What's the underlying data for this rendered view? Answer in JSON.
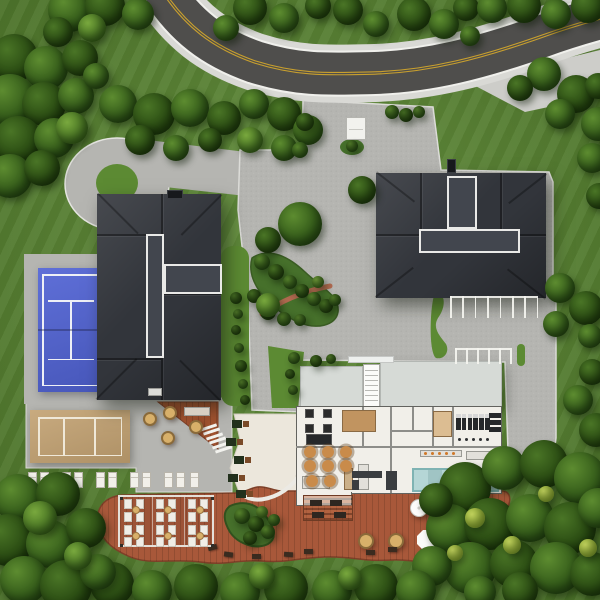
{
  "scene": {
    "description": "aerial-3d-site-plan-render-resort-clubhouse",
    "canvas": {
      "width": 600,
      "height": 600
    }
  },
  "palette": {
    "grass": "#5c8a33",
    "paving": "#b5b5b1",
    "pavingLight": "#cdcdc9",
    "curb": "#e6e6e2",
    "road": "#4f4e4c",
    "shoulder": "#d9d9d5",
    "roadEdge": "#f0f0ec",
    "roadYellow": "#c9a02e",
    "roof": "#32353b",
    "roofPanel": "#42464e",
    "roofTrim": "#e9e9e7",
    "tennis": "#5163d4",
    "tennisLine": "#eef0f6",
    "sand": "#c2a171",
    "sandLine": "#efe8d8",
    "deck": "#a8583a",
    "cream": "#ece7dc",
    "floor": "#f1efe9",
    "flatRoof": "#d6dad6",
    "pool": "#a9cfcf",
    "wood": "#c19460",
    "tableTan": "#c98b4a",
    "planter": "#46702b"
  },
  "trees": [
    [
      70,
      10,
      22,
      1
    ],
    [
      105,
      6,
      20,
      0
    ],
    [
      138,
      14,
      16,
      1
    ],
    [
      58,
      32,
      15,
      0
    ],
    [
      92,
      28,
      14,
      2
    ],
    [
      14,
      58,
      24,
      0
    ],
    [
      46,
      68,
      22,
      1
    ],
    [
      80,
      58,
      18,
      0
    ],
    [
      10,
      100,
      26,
      1
    ],
    [
      44,
      104,
      22,
      0
    ],
    [
      76,
      96,
      18,
      1
    ],
    [
      18,
      140,
      24,
      0
    ],
    [
      54,
      138,
      20,
      1
    ],
    [
      10,
      176,
      22,
      1
    ],
    [
      42,
      168,
      18,
      0
    ],
    [
      72,
      128,
      16,
      2
    ],
    [
      96,
      76,
      13,
      1
    ],
    [
      118,
      104,
      19,
      1
    ],
    [
      154,
      114,
      21,
      0
    ],
    [
      190,
      108,
      19,
      1
    ],
    [
      224,
      118,
      17,
      0
    ],
    [
      254,
      104,
      15,
      1
    ],
    [
      284,
      114,
      17,
      0
    ],
    [
      308,
      130,
      15,
      1
    ],
    [
      250,
      140,
      13,
      2
    ],
    [
      284,
      148,
      13,
      1
    ],
    [
      140,
      140,
      15,
      0
    ],
    [
      176,
      148,
      13,
      1
    ],
    [
      210,
      140,
      12,
      0
    ],
    [
      250,
      8,
      17,
      0
    ],
    [
      284,
      18,
      15,
      1
    ],
    [
      318,
      6,
      13,
      0
    ],
    [
      226,
      28,
      13,
      1
    ],
    [
      348,
      10,
      15,
      0
    ],
    [
      376,
      24,
      13,
      1
    ],
    [
      414,
      14,
      17,
      0
    ],
    [
      444,
      24,
      15,
      1
    ],
    [
      466,
      8,
      13,
      0
    ],
    [
      492,
      8,
      15,
      1
    ],
    [
      524,
      6,
      17,
      0
    ],
    [
      556,
      14,
      15,
      1
    ],
    [
      588,
      6,
      17,
      0
    ],
    [
      470,
      36,
      10,
      1
    ],
    [
      544,
      74,
      17,
      1
    ],
    [
      576,
      94,
      19,
      0
    ],
    [
      598,
      124,
      17,
      1
    ],
    [
      520,
      88,
      13,
      0
    ],
    [
      560,
      114,
      15,
      1
    ],
    [
      598,
      86,
      13,
      0
    ],
    [
      592,
      158,
      15,
      1
    ],
    [
      599,
      196,
      13,
      0
    ],
    [
      560,
      288,
      15,
      1
    ],
    [
      586,
      308,
      17,
      0
    ],
    [
      556,
      324,
      13,
      1
    ],
    [
      590,
      336,
      12,
      1
    ],
    [
      592,
      372,
      13,
      0
    ],
    [
      578,
      400,
      15,
      1
    ],
    [
      596,
      430,
      17,
      0
    ],
    [
      465,
      488,
      26,
      0
    ],
    [
      504,
      468,
      22,
      1
    ],
    [
      544,
      464,
      24,
      0
    ],
    [
      580,
      478,
      26,
      1
    ],
    [
      450,
      528,
      24,
      1
    ],
    [
      490,
      524,
      26,
      0
    ],
    [
      530,
      518,
      24,
      1
    ],
    [
      570,
      528,
      26,
      0
    ],
    [
      598,
      508,
      20,
      1
    ],
    [
      470,
      568,
      26,
      1
    ],
    [
      514,
      564,
      24,
      0
    ],
    [
      556,
      568,
      26,
      1
    ],
    [
      592,
      574,
      22,
      0
    ],
    [
      432,
      566,
      20,
      1
    ],
    [
      436,
      500,
      17,
      0
    ],
    [
      475,
      518,
      10,
      3
    ],
    [
      512,
      545,
      9,
      3
    ],
    [
      455,
      553,
      8,
      3
    ],
    [
      546,
      494,
      8,
      3
    ],
    [
      588,
      548,
      9,
      3
    ],
    [
      520,
      590,
      18,
      0
    ],
    [
      480,
      592,
      16,
      1
    ],
    [
      112,
      584,
      22,
      0
    ],
    [
      152,
      590,
      20,
      1
    ],
    [
      196,
      586,
      22,
      0
    ],
    [
      240,
      592,
      20,
      1
    ],
    [
      286,
      588,
      22,
      0
    ],
    [
      332,
      590,
      20,
      1
    ],
    [
      376,
      586,
      22,
      0
    ],
    [
      416,
      590,
      20,
      1
    ],
    [
      262,
      576,
      13,
      2
    ],
    [
      350,
      578,
      12,
      2
    ],
    [
      18,
      498,
      24,
      1
    ],
    [
      58,
      494,
      22,
      0
    ],
    [
      8,
      540,
      26,
      0
    ],
    [
      50,
      544,
      24,
      1
    ],
    [
      86,
      528,
      20,
      0
    ],
    [
      24,
      580,
      24,
      1
    ],
    [
      66,
      586,
      26,
      0
    ],
    [
      98,
      572,
      18,
      1
    ],
    [
      40,
      518,
      17,
      2
    ],
    [
      78,
      556,
      14,
      2
    ],
    [
      300,
      224,
      22,
      1
    ],
    [
      268,
      240,
      13,
      0
    ],
    [
      362,
      190,
      14,
      0
    ],
    [
      392,
      112,
      7,
      1
    ],
    [
      406,
      115,
      7,
      0
    ],
    [
      419,
      112,
      6,
      1
    ],
    [
      305,
      122,
      9,
      0
    ],
    [
      300,
      150,
      8,
      1
    ],
    [
      262,
      262,
      8,
      1
    ],
    [
      276,
      272,
      8,
      0
    ],
    [
      290,
      282,
      7,
      1
    ],
    [
      302,
      291,
      7,
      0
    ],
    [
      314,
      299,
      7,
      1
    ],
    [
      326,
      306,
      7,
      0
    ],
    [
      268,
      312,
      8,
      0
    ],
    [
      284,
      319,
      7,
      1
    ],
    [
      254,
      296,
      7,
      0
    ],
    [
      300,
      320,
      6,
      1
    ],
    [
      318,
      282,
      6,
      2
    ],
    [
      335,
      300,
      6,
      1
    ],
    [
      268,
      305,
      12,
      2
    ],
    [
      352,
      146,
      6,
      1
    ],
    [
      236,
      298,
      6,
      0
    ],
    [
      238,
      314,
      5,
      1
    ],
    [
      236,
      330,
      5,
      0
    ],
    [
      239,
      348,
      5,
      1
    ],
    [
      241,
      366,
      6,
      0
    ],
    [
      243,
      384,
      5,
      1
    ],
    [
      245,
      400,
      5,
      0
    ],
    [
      294,
      358,
      6,
      1
    ],
    [
      290,
      374,
      5,
      0
    ],
    [
      293,
      390,
      5,
      1
    ],
    [
      316,
      361,
      6,
      0
    ],
    [
      331,
      359,
      5,
      1
    ],
    [
      242,
      516,
      8,
      1
    ],
    [
      256,
      524,
      8,
      0
    ],
    [
      268,
      532,
      7,
      1
    ],
    [
      250,
      538,
      7,
      0
    ],
    [
      262,
      512,
      6,
      2
    ],
    [
      274,
      520,
      6,
      1
    ]
  ],
  "courts": {
    "tennis": {
      "x": 38,
      "y": 268,
      "w": 66,
      "h": 124
    },
    "sand": {
      "x": 30,
      "y": 410,
      "w": 100,
      "h": 53
    }
  },
  "loungers": {
    "y": 472,
    "xs": [
      28,
      40,
      62,
      74,
      96,
      108,
      130,
      142,
      164,
      176,
      190
    ]
  },
  "parking": {
    "row1": {
      "x0": 450,
      "count": 8,
      "step": 12.4,
      "y": 296,
      "len": 22
    },
    "row2": {
      "x0": 455,
      "count": 6,
      "step": 11,
      "y": 348,
      "len": 16
    }
  },
  "clubhouse": {
    "diningTables": [
      [
        310,
        452
      ],
      [
        328,
        452
      ],
      [
        346,
        452
      ],
      [
        310,
        466
      ],
      [
        328,
        466
      ],
      [
        346,
        466
      ],
      [
        312,
        481
      ],
      [
        330,
        481
      ]
    ],
    "gameTables": [
      [
        309,
        413
      ],
      [
        327,
        413
      ],
      [
        309,
        428
      ],
      [
        327,
        428
      ]
    ],
    "treadmills": {
      "x0": 456,
      "y": 414,
      "count": 6,
      "step": 5.8,
      "w": 4.5,
      "h": 16
    },
    "weightRack": [
      [
        489,
        413
      ],
      [
        489,
        420
      ],
      [
        489,
        427
      ]
    ],
    "dumbbellXs": [
      458,
      465,
      472,
      479,
      486
    ],
    "dumbbellY": 438,
    "counterItems": [
      424,
      431,
      438,
      445,
      452
    ]
  },
  "deck": {
    "umbrellas": [
      [
        418,
        507
      ],
      [
        436,
        507
      ],
      [
        453,
        507
      ],
      [
        470,
        507
      ]
    ],
    "tanTables": [
      [
        366,
        541
      ],
      [
        396,
        541
      ]
    ],
    "hexUmbrella": [
      427,
      540
    ],
    "benches": [
      [
        208,
        545,
        -15
      ],
      [
        224,
        552,
        8
      ],
      [
        252,
        554,
        0
      ],
      [
        284,
        552,
        4
      ],
      [
        304,
        549,
        0
      ],
      [
        366,
        550,
        0
      ],
      [
        388,
        547,
        0
      ],
      [
        440,
        550,
        0
      ],
      [
        464,
        538,
        -20
      ],
      [
        484,
        528,
        -30
      ],
      [
        500,
        520,
        -35
      ]
    ],
    "pergola": {
      "x": 118,
      "y": 495,
      "w": 96,
      "h": 52,
      "padCols": [
        124,
        136,
        156,
        168,
        188,
        200
      ],
      "padRows": [
        499,
        512,
        525,
        537
      ],
      "ottomans": [
        [
          132,
          506
        ],
        [
          164,
          506
        ],
        [
          196,
          506
        ],
        [
          132,
          532
        ],
        [
          164,
          532
        ],
        [
          196,
          532
        ]
      ]
    },
    "terracePergola": {
      "x": 303,
      "y": 495,
      "w": 50,
      "h": 26,
      "benches": [
        [
          310,
          500
        ],
        [
          330,
          500
        ],
        [
          312,
          512
        ],
        [
          334,
          512
        ]
      ]
    },
    "triangleTables": [
      [
        150,
        419
      ],
      [
        170,
        413
      ],
      [
        168,
        438
      ],
      [
        196,
        427
      ]
    ]
  },
  "pathBenches": [
    [
      232,
      420
    ],
    [
      226,
      438
    ],
    [
      234,
      456
    ],
    [
      228,
      474
    ],
    [
      236,
      490
    ]
  ]
}
